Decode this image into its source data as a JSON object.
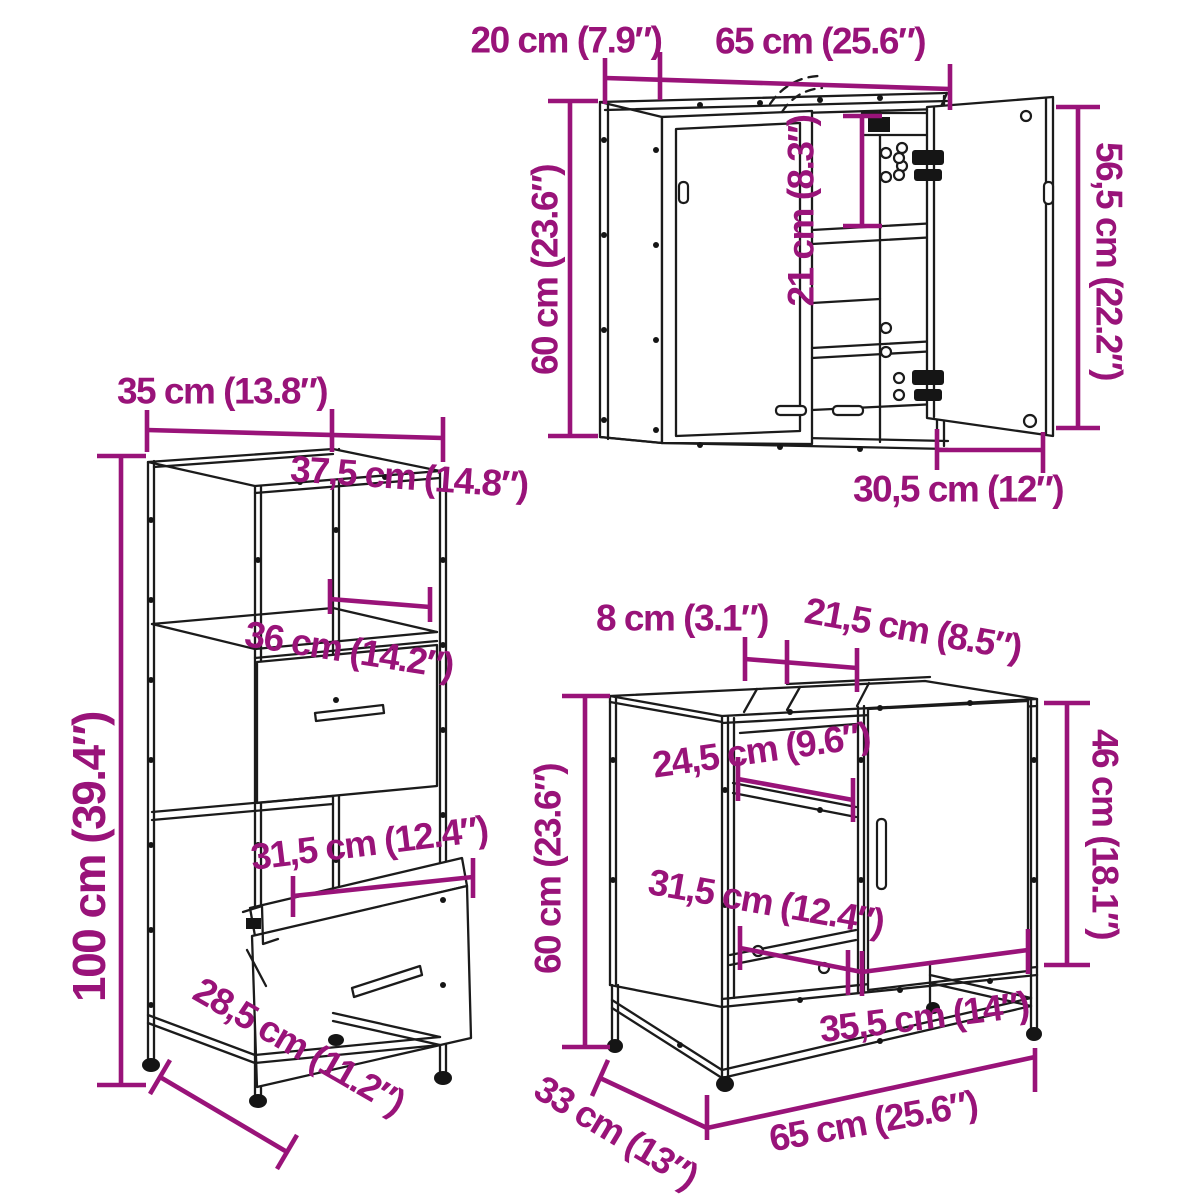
{
  "diagram": {
    "type": "furniture-dimension-diagram",
    "background": "#ffffff",
    "accent_color": "#991379",
    "line_color": "#1b1b1b",
    "cabinets": {
      "wall_cabinet": {
        "name": "bathroom mirror wall cabinet",
        "labels": {
          "depth": "20 cm (7.9″)",
          "width": "65 cm (25.6″)",
          "height": "60 cm (23.6″)",
          "inner_height": "21 cm (8.3″)",
          "door_height": "56,5 cm (22.2″)",
          "door_width": "30,5 cm (12″)"
        }
      },
      "tall_cabinet": {
        "name": "tall bathroom storage cabinet",
        "labels": {
          "width": "35 cm (13.8″)",
          "depth": "37,5 cm (14.8″)",
          "height": "100 cm (39.4″)",
          "shelf_width": "36 cm (14.2″)",
          "drawer_width": "31,5 cm (12.4″)",
          "base_depth": "28,5 cm (11.2″)"
        }
      },
      "sink_cabinet": {
        "name": "bathroom sink cabinet",
        "labels": {
          "top_gap": "8 cm (3.1″)",
          "top_depth": "21,5 cm (8.5″)",
          "height": "60 cm (23.6″)",
          "side_height": "46 cm (18.1″)",
          "shelf_width": "24,5 cm (9.6″)",
          "opening_width": "31,5 cm (12.4″)",
          "inner_width": "35,5 cm (14″)",
          "depth": "33 cm (13″)",
          "width": "65 cm (25.6″)"
        }
      }
    }
  }
}
